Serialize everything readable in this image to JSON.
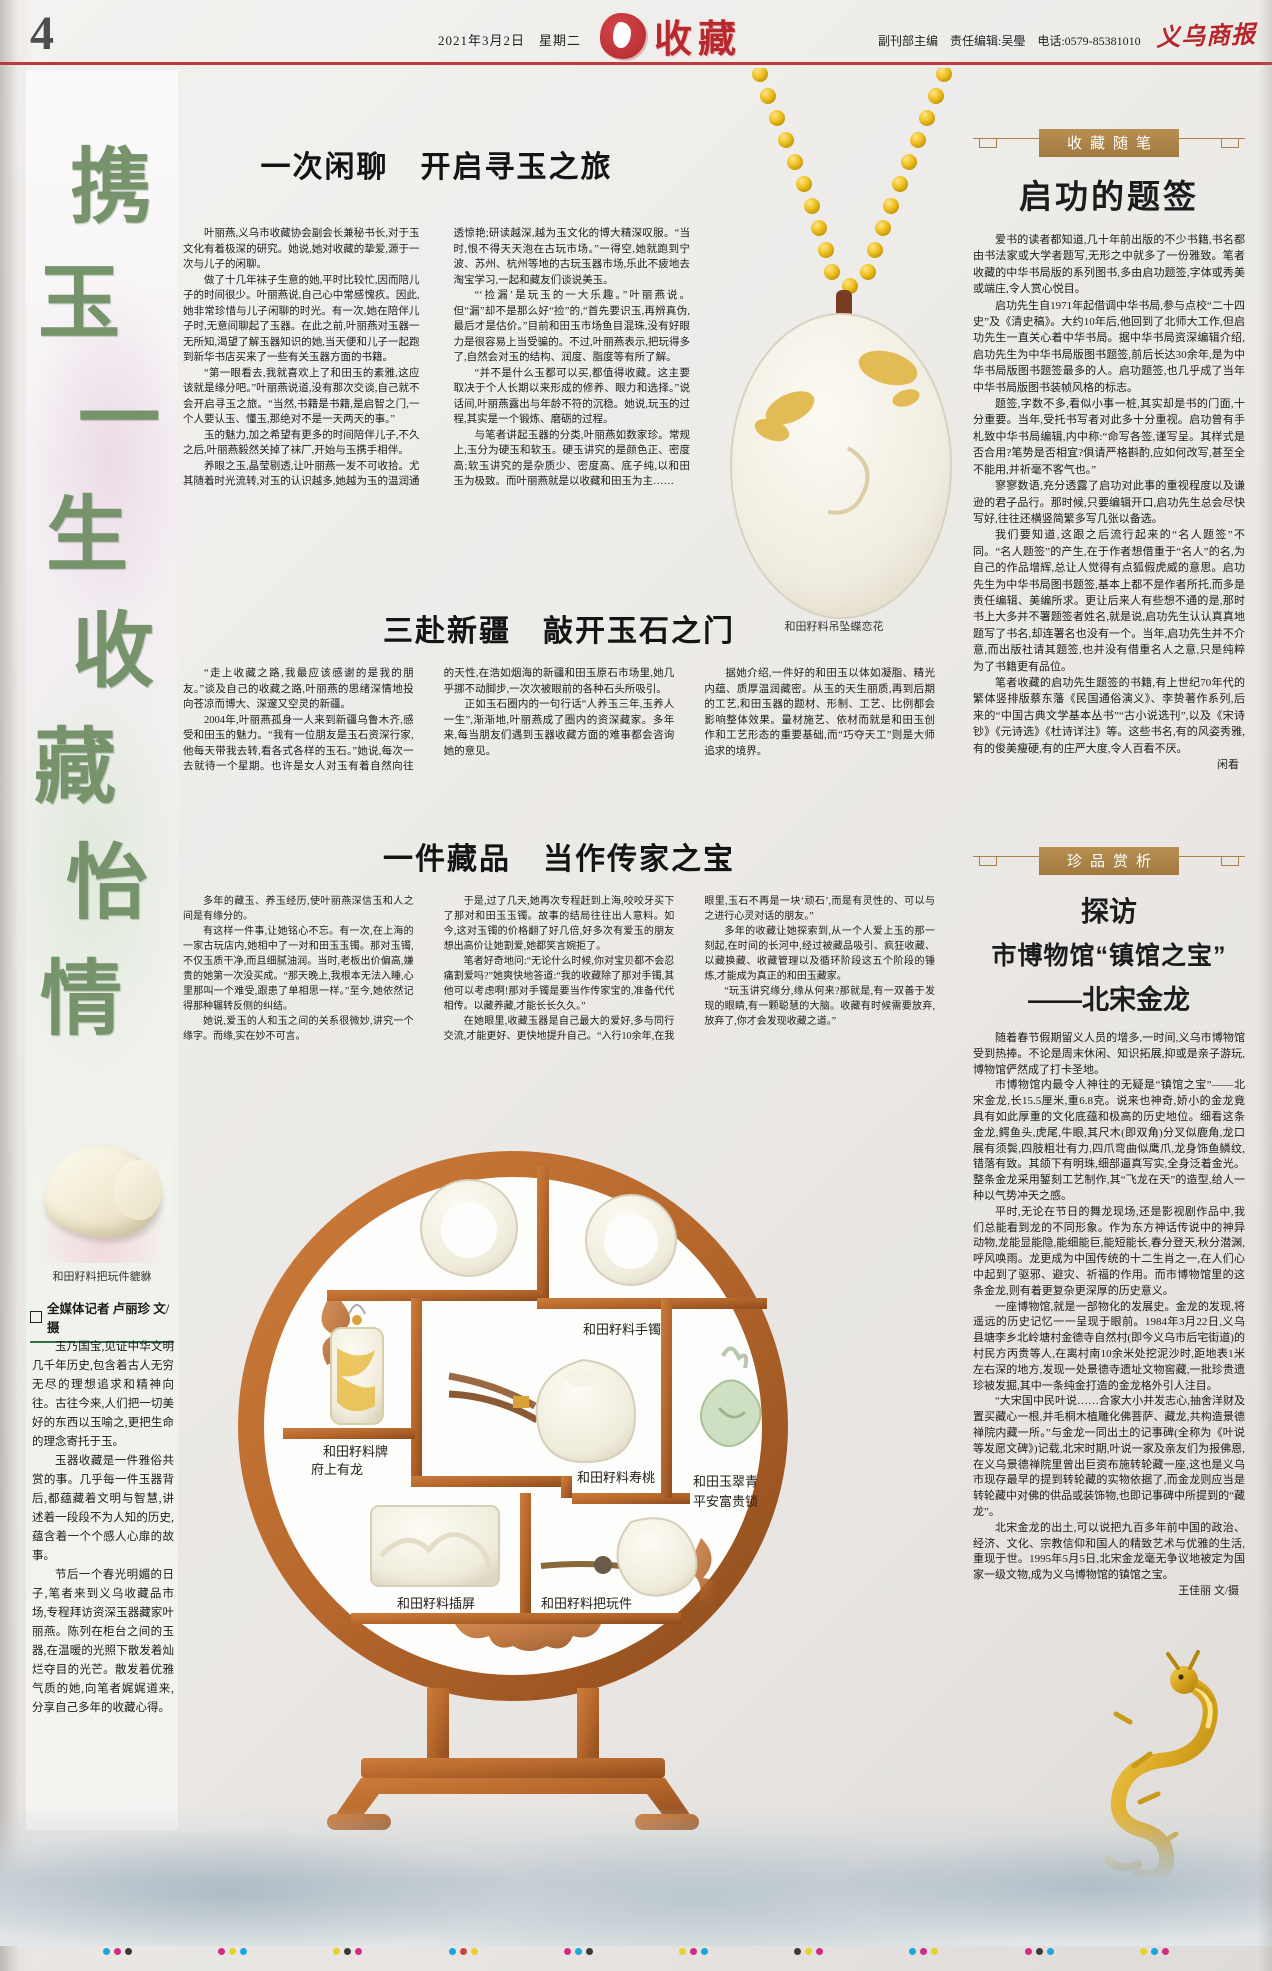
{
  "page": {
    "number": "4",
    "date": "2021年3月2日　星期二",
    "section": "收藏",
    "editor_line": "副刊部主编　责任编辑:吴璺　电话:0579-85381010",
    "masthead": "义乌商报"
  },
  "left": {
    "calligraphy": [
      "携",
      "玉",
      "一",
      "生",
      "收",
      "藏",
      "怡",
      "情"
    ],
    "photo_caption": "和田籽料把玩件貔貅",
    "byline": "全媒体记者 卢丽珍 文/摄",
    "paragraphs": [
      "玉乃国宝,见证中华文明几千年历史,包含着古人无穷无尽的理想追求和精神向往。古往今来,人们把一切美好的东西以玉喻之,更把生命的理念寄托于玉。",
      "玉器收藏是一件雅俗共赏的事。几乎每一件玉器背后,都蕴藏着文明与智慧,讲述着一段段不为人知的历史,蕴含着一个个感人心扉的故事。",
      "节后一个春光明媚的日子,笔者来到义乌收藏品市场,专程拜访资深玉器藏家叶丽燕。陈列在柜台之间的玉器,在温暖的光照下散发着灿烂夺目的光芒。散发着优雅气质的她,向笔者娓娓道来,分享自己多年的收藏心得。"
    ]
  },
  "articles": [
    {
      "title": "一次闲聊　开启寻玉之旅",
      "paragraphs": [
        "叶丽燕,义乌市收藏协会副会长兼秘书长,对于玉文化有着极深的研究。她说,她对收藏的挚爱,源于一次与儿子的闲聊。",
        "做了十几年袜子生意的她,平时比较忙,因而陪儿子的时间很少。叶丽燕说,自己心中常感愧疚。因此,她非常珍惜与儿子闲聊的时光。有一次,她在陪伴儿子时,无意间聊起了玉器。在此之前,叶丽燕对玉器一无所知,渴望了解玉器知识的她,当天便和儿子一起跑到新华书店买来了一些有关玉器方面的书籍。",
        "“第一眼看去,我就喜欢上了和田玉的素雅,这应该就是缘分吧。”叶丽燕说道,没有那次交谈,自己就不会开启寻玉之旅。“当然,书籍是书籍,是启智之门,一个人要认玉、懂玉,那绝对不是一天两天的事。”",
        "玉的魅力,加之希望有更多的时间陪伴儿子,不久之后,叶丽燕毅然关掉了袜厂,开始与玉携手相伴。",
        "养眼之玉,晶莹剔透,让叶丽燕一发不可收拾。尤其随着时光流转,对玉的认识越多,她越为玉的温润通透惊艳;研读越深,越为玉文化的博大精深叹服。“当时,恨不得天天泡在古玩市场。”一得空,她就跑到宁波、苏州、杭州等地的古玩玉器市场,乐此不疲地去淘宝学习,一起和藏友们谈说美玉。",
        "“‘捡漏’是玩玉的一大乐趣。”叶丽燕说。但“漏”却不是那么好“捡”的,“首先要识玉,再辨真伪,最后才是估价。”目前和田玉市场鱼目混珠,没有好眼力是很容易上当受骗的。不过,叶丽燕表示,把玩得多了,自然会对玉的结构、润度、脂度等有所了解。",
        "“并不是什么玉都可以买,都值得收藏。这主要取决于个人长期以来形成的修养、眼力和选择。”说话间,叶丽燕露出与年龄不符的沉稳。她说,玩玉的过程,其实是一个锻炼、磨砺的过程。",
        "与笔者讲起玉器的分类,叶丽燕如数家珍。常规上,玉分为硬玉和软玉。硬玉讲究的是颜色正、密度高;软玉讲究的是杂质少、密度高、底子纯,以和田玉为极致。而叶丽燕就是以收藏和田玉为主……"
      ]
    },
    {
      "title": "三赴新疆　敲开玉石之门",
      "paragraphs": [
        "“走上收藏之路,我最应该感谢的是我的朋友。”谈及自己的收藏之路,叶丽燕的思绪深情地投向苍凉而博大、深邃又空灵的新疆。",
        "2004年,叶丽燕孤身一人来到新疆乌鲁木齐,感受和田玉的魅力。“我有一位朋友是玉石资深行家,他每天带我去转,看各式各样的玉石。”她说,每次一去就待一个星期。也许是女人对玉有着自然向往的天性,在浩如烟海的新疆和田玉原石市场里,她几乎挪不动脚步,一次次被眼前的各种石头所吸引。",
        "正如玉石圈内的一句行话“人养玉三年,玉养人一生”,渐渐地,叶丽燕成了圈内的资深藏家。多年来,每当朋友们遇到玉器收藏方面的难事都会咨询她的意见。",
        "据她介绍,一件好的和田玉以体如凝脂、精光内蕴、质厚温润藏密。从玉的天生丽质,再到后期的工艺,和田玉器的题材、形制、工艺、比例都会影响整体效果。量材施艺、依材而就是和田玉创作和工艺形态的重要基础,而“巧夺天工”则是大师追求的境界。"
      ]
    },
    {
      "title": "一件藏品　当作传家之宝",
      "paragraphs": [
        "多年的藏玉、养玉经历,使叶丽燕深信玉和人之间是有缘分的。",
        "有这样一件事,让她铭心不忘。有一次,在上海的一家古玩店内,她相中了一对和田玉玉镯。那对玉镯,不仅玉质干净,而且细腻油润。当时,老板出价偏高,嫌贵的她第一次没买成。“那天晚上,我根本无法入睡,心里那叫一个难受,跟患了单相思一样。”至今,她依然记得那种辗转反侧的纠结。",
        "她说,爱玉的人和玉之间的关系很微妙,讲究一个缘字。而缘,实在妙不可言。",
        "于是,过了几天,她再次专程赶到上海,咬咬牙买下了那对和田玉玉镯。故事的结局往往出人意料。如今,这对玉镯的价格翻了好几倍,好多次有爱玉的朋友想出高价让她割爱,她都笑言婉拒了。",
        "笔者好奇地问:“无论什么时候,你对宝贝都不会忍痛割爱吗?”她爽快地答道:“我的收藏除了那对手镯,其他可以考虑啊!那对手镯是要当作传家宝的,准备代代相传。以藏养藏,才能长长久久。”",
        "在她眼里,收藏玉器是自己最大的爱好,多与同行交流,才能更好、更快地提升自己。“入行10余年,在我眼里,玉石不再是一块‘顽石’,而是有灵性的、可以与之进行心灵对话的朋友。”",
        "多年的收藏让她探索到,从一个人爱上玉的那一刻起,在时间的长河中,经过被藏品吸引、疯狂收藏、以藏换藏、收藏管理以及循环阶段这五个阶段的锤炼,才能成为真正的和田玉藏家。",
        "“玩玉讲究缘分,缘从何来?那就是,有一双善于发现的眼睛,有一颗聪慧的大脑。收藏有时候需要放弃,放弃了,你才会发现收藏之道。”"
      ]
    }
  ],
  "pendant": {
    "caption": "和田籽料吊坠蝶恋花"
  },
  "essay": {
    "box": "收藏随笔",
    "title": "启功的题签",
    "paragraphs": [
      "爱书的读者都知道,几十年前出版的不少书籍,书名都由书法家或大学者题写,无形之中就多了一份雅致。笔者收藏的中华书局版的系列图书,多由启功题签,字体或秀美或端庄,令人赏心悦目。",
      "启功先生自1971年起借调中华书局,参与点校“二十四史”及《清史稿》。大约10年后,他回到了北师大工作,但启功先生一直关心着中华书局。据中华书局资深编辑介绍,启功先生为中华书局版图书题签,前后长达30余年,是为中华书局版图书题签最多的人。启功题签,也几乎成了当年中华书局版图书装帧风格的标志。",
      "题签,字数不多,看似小事一桩,其实却是书的门面,十分重要。当年,受托书写者对此多十分重视。启功曾有手札致中华书局编辑,内中称:“命写各签,谨写呈。其样式是否合用?笔势是否相宜?俱请严格斟酌,应如何改写,甚至全不能用,并祈毫不客气也。”",
      "寥寥数语,充分透露了启功对此事的重视程度以及谦逊的君子品行。那时候,只要编辑开口,启功先生总会尽快写好,往往还横竖简繁多写几张以备选。",
      "我们要知道,这跟之后流行起来的“名人题签”不同。“名人题签”的产生,在于作者想借重于“名人”的名,为自己的作品增辉,总让人觉得有点狐假虎威的意思。启功先生为中华书局图书题签,基本上都不是作者所托,而多是责任编辑、美编所求。更让后来人有些想不通的是,那时书上大多并不署题签者姓名,就是说,启功先生认认真真地题写了书名,却连署名也没有一个。当年,启功先生并不介意,而出版社请其题签,也并没有借重名人之意,只是纯粹为了书籍更有品位。",
      "笔者收藏的启功先生题签的书籍,有上世纪70年代的繁体竖排版蔡东藩《民国通俗演义》、李贽著作系列,后来的“中国古典文学基本丛书”“古小说选刊”,以及《宋诗钞》《元诗选》《杜诗详注》等。这些书名,有的风姿秀雅,有的俊美瘦硬,有的庄严大度,令人百看不厌。"
    ],
    "author": "闲看"
  },
  "treasure": {
    "box": "珍品赏析",
    "title_line1": "探访",
    "title_line2": "市博物馆“镇馆之宝”",
    "title_line3": "——北宋金龙",
    "paragraphs": [
      "随着春节假期留义人员的增多,一时间,义乌市博物馆受到热捧。不论是周末休闲、知识拓展,抑或是亲子游玩,博物馆俨然成了打卡圣地。",
      "市博物馆内最令人神往的无疑是“镇馆之宝”——北宋金龙,长15.5厘米,重6.8克。说来也神奇,娇小的金龙竟具有如此厚重的文化底蕴和极高的历史地位。细看这条金龙,鳄鱼头,虎尾,牛眼,其尺木(即双角)分叉似鹿角,龙口展有须鬓,四肢粗壮有力,四爪弯曲似鹰爪,龙身饰鱼鳞纹,错落有致。其颌下有明珠,细部逼真写实,全身泛着金光。整条金龙采用錾刻工艺制作,其“飞龙在天”的造型,给人一种以气势冲天之感。",
      "平时,无论在节日的舞龙现场,还是影视剧作品中,我们总能看到龙的不同形象。作为东方神话传说中的神异动物,龙能显能隐,能细能巨,能短能长,春分登天,秋分潜渊,呼风唤雨。龙更成为中国传统的十二生肖之一,在人们心中起到了驱邪、避灾、祈福的作用。而市博物馆里的这条金龙,则有着更复杂更深厚的历史意义。",
      "一座博物馆,就是一部物化的发展史。金龙的发现,将遥远的历史记忆一一呈现于眼前。1984年3月22日,义乌县塘李乡北岭塘村金德寺自然村(即今义乌市后宅街道)的村民方丙贵等人,在离村南10余米处挖泥沙时,距地表1米左右深的地方,发现一处景德寺遗址文物窖藏,一批珍贵遗珍被发掘,其中一条纯金打造的金龙格外引人注目。",
      "“大宋国中民叶说……合家大小并发志心,抽舍洋财及置买藏心一根,并毛桐木植雕化佛菩萨、藏龙,共构造景德禅院内藏一所。”与金龙一同出土的记事碑(全称为《叶说等发愿文碑》)记载,北宋时期,叶说一家及亲友们为报佛恩,在义乌景德禅院里曾出巨资布施转轮藏一座,这也是义乌市现存最早的提到转轮藏的实物依据了,而金龙则应当是转轮藏中对佛的供品或装饰物,也即记事碑中所提到的“藏龙”。",
      "北宋金龙的出土,可以说把九百多年前中国的政治、经济、文化、宗教信仰和国人的精致艺术与优雅的生活,重现于世。1995年5月5日,北宋金龙毫无争议地被定为国家一级文物,成为义乌博物馆的镇馆之宝。"
    ],
    "author": "王佳丽 文/摄",
    "dragon_caption": "北宋金龙"
  },
  "shelf": {
    "captions": {
      "bangles": "和田籽料手镯",
      "plaque_l1": "和田籽料牌",
      "plaque_l2": "府上有龙",
      "peach": "和田籽料寿桃",
      "lock_l1": "和田玉翠青",
      "lock_l2": "平安富贵锁",
      "screen": "和田籽料插屏",
      "hand_piece": "和田籽料把玩件"
    }
  },
  "colors": {
    "accent_red": "#bb3a3e",
    "gold": "#a9824a",
    "wood": "#b5672c",
    "calligraphy_green": "#76936c"
  }
}
